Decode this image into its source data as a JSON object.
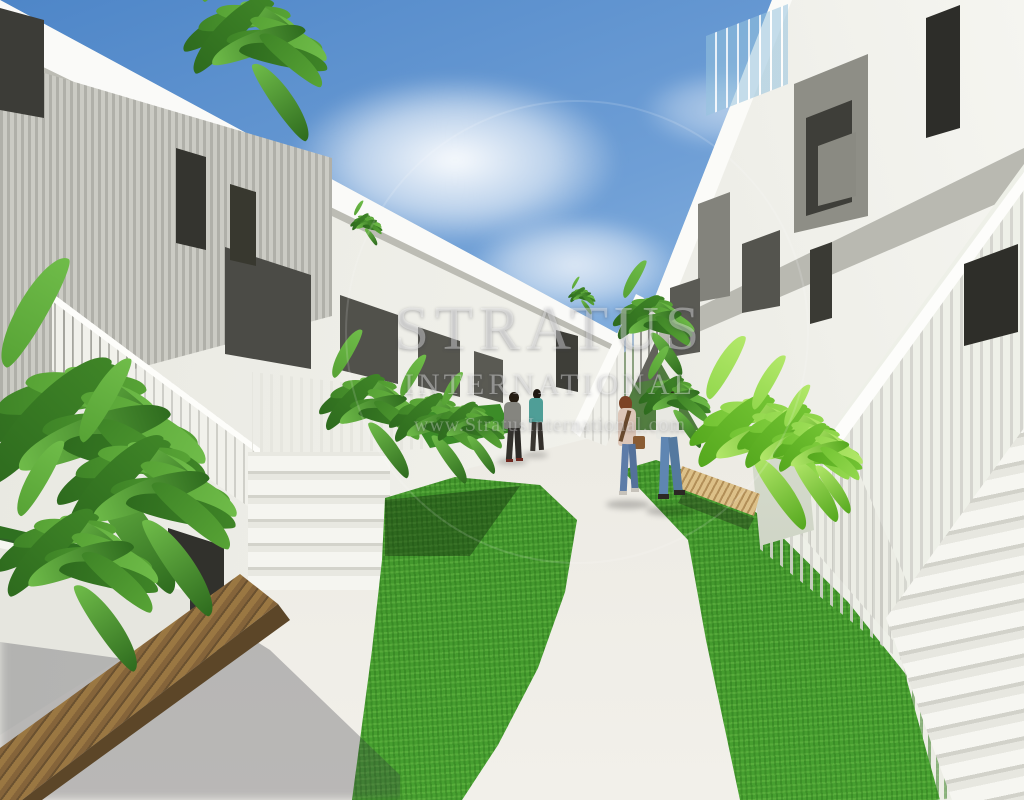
{
  "image": {
    "subject": "courtyard of a modern white apartment complex with staircases, lawns, planters and a winding concrete path",
    "people_visible": 4
  },
  "watermark": {
    "title": "STRATUS",
    "subtitle": "INTERNATIONAL",
    "url": "www.StratusInternational.com"
  },
  "palette": {
    "sky_blue": "#4e86c8",
    "building_white": "#f2f2ec",
    "balcony_dark_gray": "#4b4b46",
    "grass_green": "#3c8c28",
    "foliage_green": "#57a335",
    "bench_wood": "#8a683a",
    "glass_blue": "#9ac3de",
    "path_concrete": "#e9e7e0"
  }
}
